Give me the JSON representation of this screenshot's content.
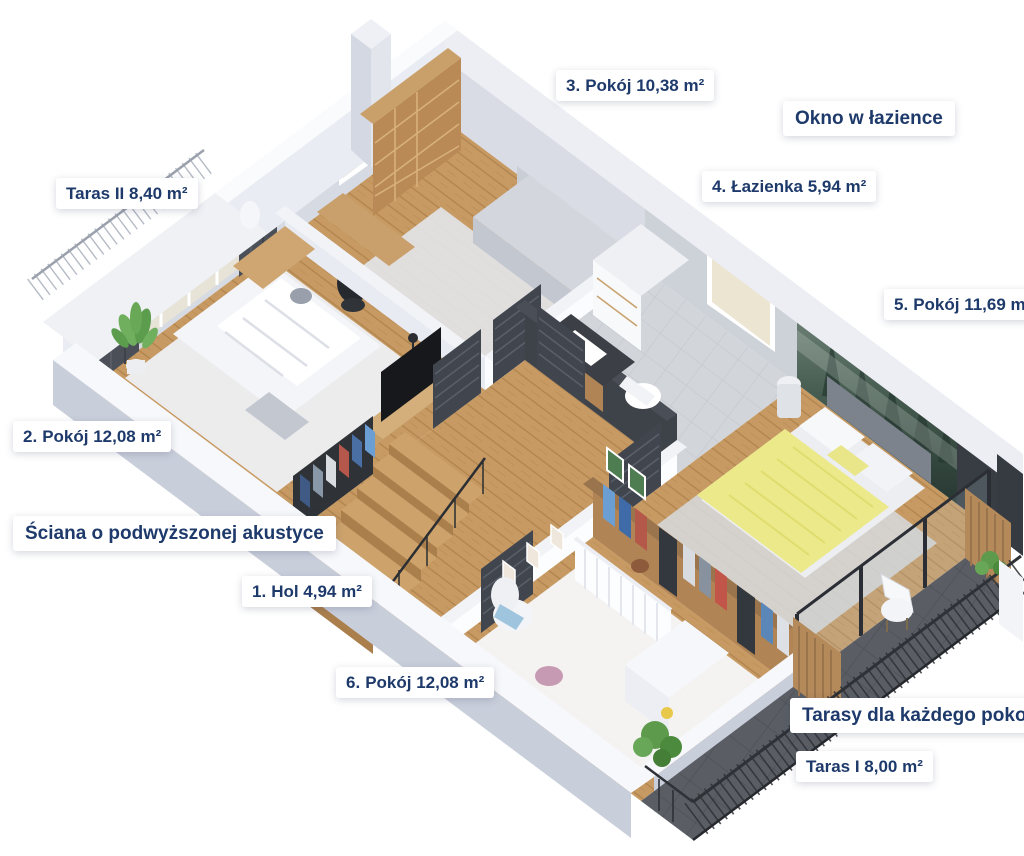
{
  "colors": {
    "label_text": "#1e3a6b",
    "label_bg": "#ffffff",
    "wood_floor": "#c79a63",
    "charcoal": "#383d44",
    "terrace_tile": "#5a5e64",
    "duvet_yellow": "#ece98b",
    "mural_green": "#3c5147"
  },
  "labels": {
    "room3": {
      "num": "3.",
      "text": "Pokój 10,38 m²"
    },
    "okno": {
      "text": "Okno w łazience"
    },
    "taras2": {
      "text": "Taras II 8,40 m²"
    },
    "lazienka": {
      "num": "4.",
      "text": "Łazienka 5,94 m²"
    },
    "room5": {
      "num": "5.",
      "text": "Pokój 11,69 m²"
    },
    "room2": {
      "num": "2.",
      "text": "Pokój 12,08 m²"
    },
    "sciana": {
      "text": "Ściana o podwyższonej akustyce"
    },
    "hol": {
      "num": "1.",
      "text": "Hol 4,94 m²"
    },
    "room6": {
      "num": "6.",
      "text": "Pokój 12,08 m²"
    },
    "tarasy": {
      "text": "Tarasy dla każdego pokoju"
    },
    "taras1": {
      "text": "Taras I 8,00 m²"
    }
  }
}
